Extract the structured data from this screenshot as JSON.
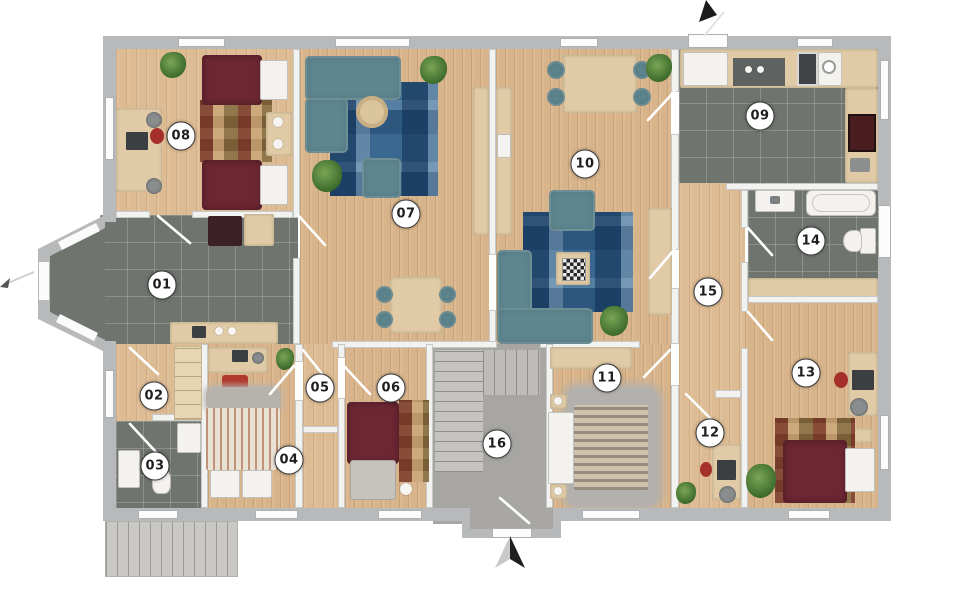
{
  "floorplan": {
    "rooms": [
      {
        "label": "01"
      },
      {
        "label": "02"
      },
      {
        "label": "03"
      },
      {
        "label": "04"
      },
      {
        "label": "05"
      },
      {
        "label": "06"
      },
      {
        "label": "07"
      },
      {
        "label": "08"
      },
      {
        "label": "09"
      },
      {
        "label": "10"
      },
      {
        "label": "11"
      },
      {
        "label": "12"
      },
      {
        "label": "13"
      },
      {
        "label": "14"
      },
      {
        "label": "15"
      },
      {
        "label": "16"
      }
    ],
    "icons": {
      "north_arrow_bottom": "two-tone up-pointing compass arrow",
      "entrance_arrow_top": "black arrow at top entrance door",
      "entrance_arrow_left": "thin line arrow at bay entrance"
    },
    "colors": {
      "wood_floor": "#d8b48b",
      "tile_floor": "#6f746e",
      "exterior_wall": "#b7b9bb",
      "interior_wall": "#f2f2f1",
      "sofa_teal": "#5e868f",
      "bed_maroon": "#6d2734",
      "rug_blue": "#3a6890",
      "furniture_beige": "#e0cba6",
      "stair_gray": "#c5c4c1",
      "plant_green": "#41702f",
      "badge_background": "#ffffff",
      "badge_text": "#1e1e1e"
    }
  }
}
